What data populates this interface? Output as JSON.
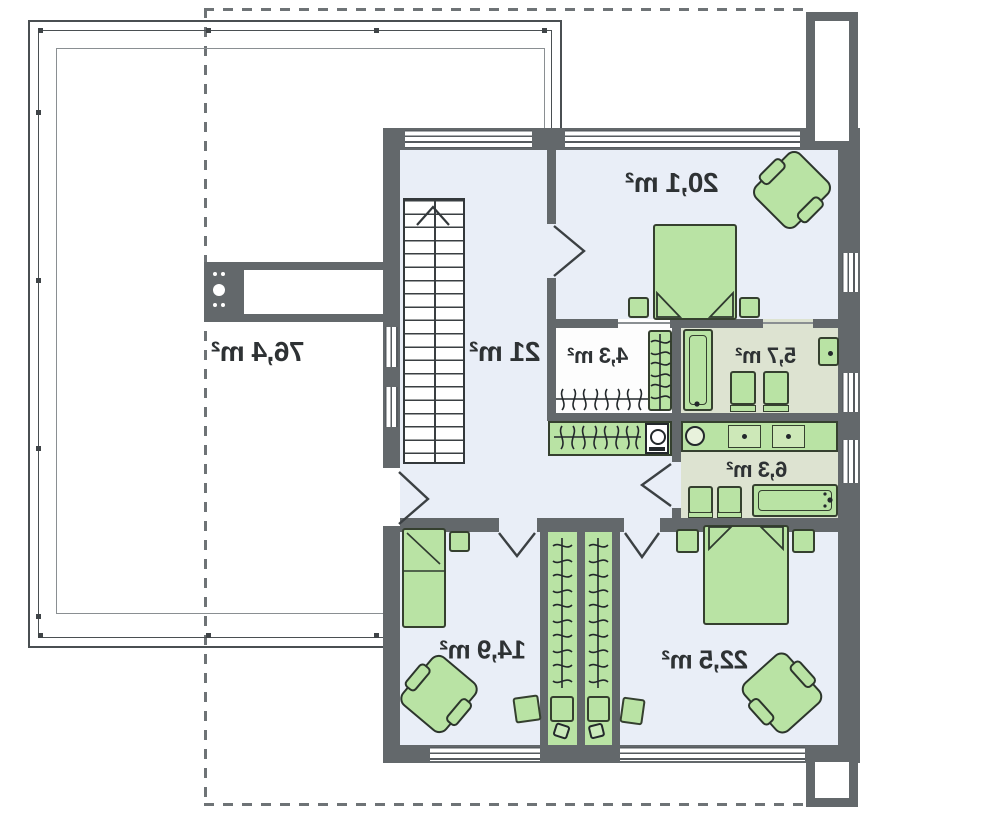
{
  "plan": {
    "type": "floor-plan",
    "orientation": "mirrored",
    "unit": "m²",
    "rooms": {
      "terrace": {
        "name": "roof terrace",
        "area": "76,4 m²"
      },
      "hall": {
        "name": "hall / staircase",
        "area": "21 m²"
      },
      "bedroom_top": {
        "name": "bedroom top right",
        "area": "20,1 m²"
      },
      "wardrobe": {
        "name": "wardrobe",
        "area": "4,3 m²"
      },
      "bathroom_upper": {
        "name": "bathroom upper",
        "area": "5,7 m²"
      },
      "bathroom_lower": {
        "name": "bathroom lower",
        "area": "6,3 m²"
      },
      "bedroom_left": {
        "name": "bedroom bottom left",
        "area": "14,9 m²"
      },
      "bedroom_right": {
        "name": "bedroom bottom right",
        "area": "22,5 m²"
      }
    },
    "colors": {
      "wall": "#63686b",
      "floor": "#e9eef7",
      "bath_floor": "#dde3d1",
      "furniture_fill": "#b9e3a4",
      "furniture_outline": "#35402f",
      "label_text": "#2e3234",
      "roof_dashed": "#6e7376"
    }
  }
}
